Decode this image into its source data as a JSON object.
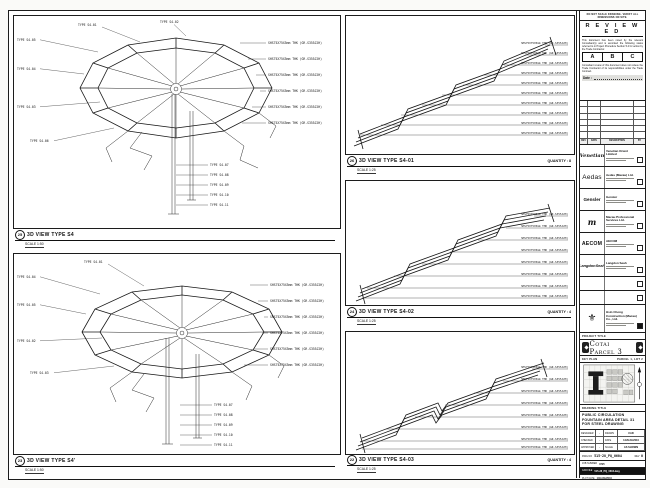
{
  "sheet_note": "DO NOT SCALE DRAWING. VERIFY ALL DIMENSIONS ON SITE.",
  "stamp": {
    "title": "R E V I E W E D",
    "para1": "This document has been noted by the relevant Consultant(s) and is accorded the following status referred to in Project Procedure Section 5.4 for action by the Trade Contractor.",
    "options": [
      "A",
      "B",
      "C"
    ],
    "para2": "Consultant review of this document does not relieve the Trade Contractor of its responsibilities under the Trade Contract.",
    "date_label": "Date :"
  },
  "revision_table": {
    "headers": [
      "REV",
      "DATE",
      "DESCRIPTION",
      "BY"
    ]
  },
  "consultants": [
    {
      "logo": "Venetian",
      "name": "Venetian Orient Limited"
    },
    {
      "logo": "Aedas",
      "name": "Aedas (Macau) Ltd."
    },
    {
      "logo": "Gensler",
      "name": "Gensler"
    },
    {
      "logo": "m",
      "name": "Macau Professional Services Ltd."
    },
    {
      "logo": "AECOM",
      "name": "AECOM"
    },
    {
      "logo": "LangdonSeah",
      "name": "Langdon Seah"
    },
    {
      "logo": "",
      "name": ""
    },
    {
      "logo": "",
      "name": ""
    },
    {
      "logo": "⚜",
      "name": "Hsin Chong Construction (Macau) Co., Ltd."
    }
  ],
  "project": {
    "label": "PROJECT TITLE",
    "title": "Cotai Parcel 3"
  },
  "keyplan": {
    "label": "KEY PLAN",
    "parcel": "PARCEL 1, LOT 2"
  },
  "drawing": {
    "label": "DRAWING TITLE",
    "lines": [
      "PUBLIC CIRCULATION",
      "FOUNTAIN AREA DETAIL 31",
      "FOR STEEL DRAWING"
    ]
  },
  "info": {
    "designer_label": "DESIGNER",
    "designer": "-",
    "drawn_label": "DRAWN",
    "drawn": "CAD",
    "checked_label": "CHECKED",
    "checked": "-",
    "date_label": "DATE",
    "date": "14/AUG/2010",
    "approved_label": "APPROVED",
    "approved": "-",
    "scale_label": "SCALE",
    "scale": "AS SHOWN"
  },
  "numbers": {
    "dwg_label": "DWG NO",
    "dwg": "515-28_PQ_0604",
    "rev_label": "REV",
    "rev": "0",
    "job_label": "JOB NUMBER",
    "job": "0725",
    "cad_label": "CAD FILE",
    "cad": "515-28_PQ_0604.dwg",
    "plot_label": "PLOT DATE",
    "plot": "14/AUG/2010"
  },
  "panels": [
    {
      "number": "25",
      "title": "3D VIEW TYPE S4",
      "scale": "SCALE 1:50",
      "quantity": "",
      "callouts": [
        {
          "t": "TYPE S4-05",
          "x": 3,
          "y": 25,
          "l": [
            26,
            23.8,
            84,
            36
          ]
        },
        {
          "t": "TYPE S4-04",
          "x": 3,
          "y": 54,
          "l": [
            26,
            52.8,
            70,
            58
          ]
        },
        {
          "t": "TYPE S4-03",
          "x": 3,
          "y": 92,
          "l": [
            26,
            90.8,
            86,
            86
          ]
        },
        {
          "t": "TYPE S4-06",
          "x": 16,
          "y": 126,
          "l": [
            40,
            124.8,
            100,
            112
          ]
        },
        {
          "t": "TYPE S4-01",
          "x": 64,
          "y": 10,
          "l": [
            88,
            11,
            126,
            26
          ]
        },
        {
          "t": "TYPE S4-02",
          "x": 146,
          "y": 7,
          "l": [
            160,
            8.5,
            172,
            20
          ]
        },
        {
          "t": "SHS75X75X5mm THK (GR.S355J2H)",
          "x": 254,
          "y": 28,
          "l": [
            226,
            27,
            252,
            27
          ]
        },
        {
          "t": "SHS75X75X5mm THK (GR.S355J2H)",
          "x": 254,
          "y": 44,
          "l": [
            234,
            43,
            252,
            43
          ]
        },
        {
          "t": "SHS75X75X5mm THK (GR.S355J2H)",
          "x": 254,
          "y": 60,
          "l": [
            242,
            59,
            252,
            59
          ]
        },
        {
          "t": "SHS75X75X5mm THK (GR.S355J2H)",
          "x": 254,
          "y": 76,
          "l": [
            246,
            75,
            252,
            75
          ]
        },
        {
          "t": "SHS75X75X5mm THK (GR.S355J2H)",
          "x": 254,
          "y": 92,
          "l": [
            238,
            91,
            252,
            91
          ]
        },
        {
          "t": "SHS75X75X5mm THK (GR.S355J2H)",
          "x": 254,
          "y": 108,
          "l": [
            228,
            107,
            252,
            107
          ]
        },
        {
          "t": "TYPE S4-07",
          "x": 196,
          "y": 150,
          "l": [
            162,
            149,
            194,
            149
          ]
        },
        {
          "t": "TYPE S4-08",
          "x": 196,
          "y": 160,
          "l": [
            162,
            159,
            194,
            159
          ]
        },
        {
          "t": "TYPE S4-09",
          "x": 196,
          "y": 170,
          "l": [
            162,
            169,
            194,
            169
          ]
        },
        {
          "t": "TYPE S4-10",
          "x": 196,
          "y": 180,
          "l": [
            162,
            179,
            194,
            179
          ]
        },
        {
          "t": "TYPE S4-11",
          "x": 196,
          "y": 190,
          "l": [
            162,
            189,
            194,
            189
          ]
        }
      ]
    },
    {
      "number": "23",
      "title": "3D VIEW TYPE S4'",
      "scale": "SCALE 1:50",
      "quantity": "",
      "callouts": [
        {
          "t": "TYPE S4-04",
          "x": 3,
          "y": 24,
          "l": [
            26,
            22.8,
            86,
            40
          ]
        },
        {
          "t": "TYPE S4-05",
          "x": 3,
          "y": 52,
          "l": [
            26,
            50.8,
            72,
            60
          ]
        },
        {
          "t": "TYPE S4-02",
          "x": 3,
          "y": 88,
          "l": [
            26,
            86.8,
            88,
            84
          ]
        },
        {
          "t": "TYPE S4-03",
          "x": 16,
          "y": 120,
          "l": [
            40,
            118.8,
            100,
            112
          ]
        },
        {
          "t": "TYPE S4-01",
          "x": 70,
          "y": 9,
          "l": [
            94,
            10,
            130,
            32
          ]
        },
        {
          "t": "SHS75X75X5mm THK (GR.S355J2H)",
          "x": 256,
          "y": 32,
          "l": [
            236,
            31,
            254,
            31
          ]
        },
        {
          "t": "SHS75X75X5mm THK (GR.S355J2H)",
          "x": 256,
          "y": 48,
          "l": [
            244,
            47,
            254,
            47
          ]
        },
        {
          "t": "SHS75X75X5mm THK (GR.S355J2H)",
          "x": 256,
          "y": 64,
          "l": [
            250,
            63,
            254,
            63
          ]
        },
        {
          "t": "SHS75X75X5mm THK (GR.S355J2H)",
          "x": 256,
          "y": 80,
          "l": [
            248,
            79,
            254,
            79
          ]
        },
        {
          "t": "SHS75X75X5mm THK (GR.S355J2H)",
          "x": 256,
          "y": 96,
          "l": [
            240,
            95,
            254,
            95
          ]
        },
        {
          "t": "SHS75X75X5mm THK (GR.S355J2H)",
          "x": 256,
          "y": 112,
          "l": [
            230,
            111,
            254,
            111
          ]
        },
        {
          "t": "TYPE S4-07",
          "x": 200,
          "y": 152,
          "l": [
            166,
            151,
            198,
            151
          ]
        },
        {
          "t": "TYPE S4-08",
          "x": 200,
          "y": 162,
          "l": [
            166,
            161,
            198,
            161
          ]
        },
        {
          "t": "TYPE S4-09",
          "x": 200,
          "y": 172,
          "l": [
            166,
            171,
            198,
            171
          ]
        },
        {
          "t": "TYPE S4-10",
          "x": 200,
          "y": 182,
          "l": [
            166,
            181,
            198,
            181
          ]
        },
        {
          "t": "TYPE S4-11",
          "x": 200,
          "y": 192,
          "l": [
            166,
            191,
            198,
            191
          ]
        }
      ]
    },
    {
      "number": "26",
      "title": "3D VIEW TYPE S4-01",
      "scale": "SCALE 1:25",
      "quantity": "QUANTITY : 8",
      "callouts": [
        {
          "t": "SHS75X75X5mm THK (GR.S355J2H)",
          "x": 222,
          "y": 28,
          "a": "end",
          "l": [
            199,
            29,
            222,
            29
          ]
        },
        {
          "t": "SHS75X75X5mm THK (GR.S355J2H)",
          "x": 222,
          "y": 38,
          "a": "end",
          "l": [
            179,
            39,
            222,
            39
          ]
        },
        {
          "t": "SHS75X75X5mm THK (GR.S355J2H)",
          "x": 222,
          "y": 48,
          "a": "end",
          "l": [
            158,
            49,
            222,
            49
          ]
        },
        {
          "t": "SHS75X75X5mm THK (GR.S355J2H)",
          "x": 222,
          "y": 58,
          "a": "end",
          "l": [
            138,
            59,
            222,
            59
          ]
        },
        {
          "t": "SHS75X75X5mm THK (GR.S355J2H)",
          "x": 222,
          "y": 68,
          "a": "end",
          "l": [
            117,
            69,
            222,
            69
          ]
        },
        {
          "t": "SHS75X75X5mm THK (GR.S355J2H)",
          "x": 222,
          "y": 78,
          "a": "end",
          "l": [
            96,
            79,
            222,
            79
          ]
        },
        {
          "t": "SHS75X75X5mm THK (GR.S355J2H)",
          "x": 222,
          "y": 88,
          "a": "end",
          "l": [
            76,
            89,
            222,
            89
          ]
        },
        {
          "t": "SHS75X75X5mm THK (GR.S355J2H)",
          "x": 222,
          "y": 98,
          "a": "end",
          "l": [
            55,
            99,
            222,
            99
          ]
        },
        {
          "t": "SHS75X75X5mm THK (GR.S355J2H)",
          "x": 222,
          "y": 108,
          "a": "end",
          "l": [
            35,
            109,
            222,
            109
          ]
        },
        {
          "t": "SHS75X75X5mm THK (GR.S355J2H)",
          "x": 222,
          "y": 118,
          "a": "end",
          "l": [
            14,
            119,
            222,
            119
          ]
        }
      ]
    },
    {
      "number": "24",
      "title": "3D VIEW TYPE S4-02",
      "scale": "SCALE 1:25",
      "quantity": "QUANTITY : 4",
      "callouts": [
        {
          "t": "SHS75X75X5mm THK (GR.S355J2H)",
          "x": 222,
          "y": 34,
          "a": "end",
          "l": [
            188,
            35,
            222,
            35
          ]
        },
        {
          "t": "SHS75X75X5mm THK (GR.S355J2H)",
          "x": 222,
          "y": 46,
          "a": "end",
          "l": [
            160,
            47,
            222,
            47
          ]
        },
        {
          "t": "SHS75X75X5mm THK (GR.S355J2H)",
          "x": 222,
          "y": 58,
          "a": "end",
          "l": [
            132,
            59,
            222,
            59
          ]
        },
        {
          "t": "SHS75X75X5mm THK (GR.S355J2H)",
          "x": 222,
          "y": 70,
          "a": "end",
          "l": [
            104,
            71,
            222,
            71
          ]
        },
        {
          "t": "SHS75X75X5mm THK (GR.S355J2H)",
          "x": 222,
          "y": 82,
          "a": "end",
          "l": [
            76,
            83,
            222,
            83
          ]
        },
        {
          "t": "SHS75X75X5mm THK (GR.S355J2H)",
          "x": 222,
          "y": 94,
          "a": "end",
          "l": [
            48,
            95,
            222,
            95
          ]
        },
        {
          "t": "SHS75X75X5mm THK (GR.S355J2H)",
          "x": 222,
          "y": 106,
          "a": "end",
          "l": [
            21,
            107,
            222,
            107
          ]
        },
        {
          "t": "SHS75X75X5mm THK (GR.S355J2H)",
          "x": 222,
          "y": 116,
          "a": "end",
          "l": [
            16,
            117,
            222,
            117
          ]
        }
      ]
    },
    {
      "number": "22",
      "title": "3D VIEW TYPE S4-03",
      "scale": "SCALE 1:25",
      "quantity": "QUANTITY : 4",
      "callouts": [
        {
          "t": "SHS75X75X5mm THK (GR.S355J2H)",
          "x": 222,
          "y": 36,
          "a": "end",
          "l": [
            186,
            37,
            222,
            37
          ]
        },
        {
          "t": "SHS75X75X5mm THK (GR.S355J2H)",
          "x": 222,
          "y": 48,
          "a": "end",
          "l": [
            157,
            49,
            222,
            49
          ]
        },
        {
          "t": "SHS75X75X5mm THK (GR.S355J2H)",
          "x": 222,
          "y": 60,
          "a": "end",
          "l": [
            128,
            61,
            222,
            61
          ]
        },
        {
          "t": "SHS75X75X5mm THK (GR.S355J2H)",
          "x": 222,
          "y": 72,
          "a": "end",
          "l": [
            99,
            73,
            222,
            73
          ]
        },
        {
          "t": "SHS75X75X5mm THK (GR.S355J2H)",
          "x": 222,
          "y": 84,
          "a": "end",
          "l": [
            69,
            85,
            222,
            85
          ]
        },
        {
          "t": "SHS75X75X5mm THK (GR.S355J2H)",
          "x": 222,
          "y": 96,
          "a": "end",
          "l": [
            40,
            97,
            222,
            97
          ]
        },
        {
          "t": "SHS75X75X5mm THK (GR.S355J2H)",
          "x": 222,
          "y": 108,
          "a": "end",
          "l": [
            16,
            109,
            222,
            109
          ]
        },
        {
          "t": "SHS75X75X5mm THK (GR.S355J2H)",
          "x": 222,
          "y": 116,
          "a": "end",
          "l": [
            16,
            117,
            222,
            117
          ]
        }
      ]
    }
  ]
}
